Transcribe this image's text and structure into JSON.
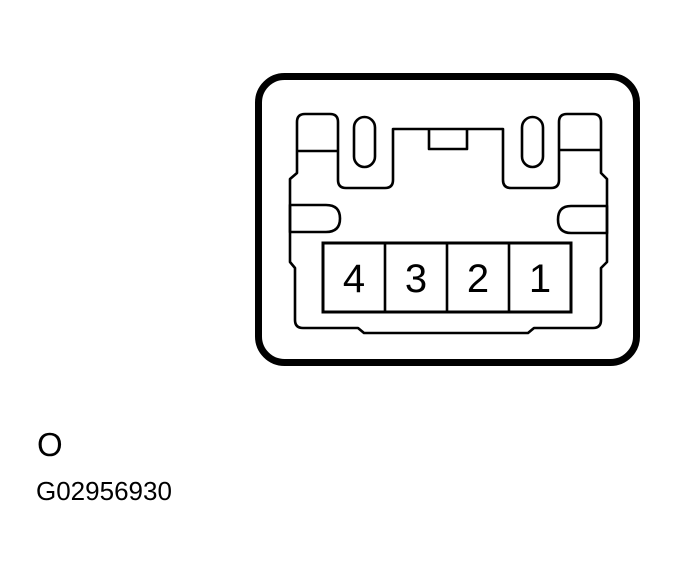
{
  "figure": {
    "type": "connector-pinout-diagram",
    "description": "4-pin electrical connector face view",
    "pins": [
      "4",
      "3",
      "2",
      "1"
    ],
    "caption_letter": "O",
    "figure_id": "G02956930",
    "colors": {
      "line": "#000000",
      "background": "#ffffff"
    }
  }
}
